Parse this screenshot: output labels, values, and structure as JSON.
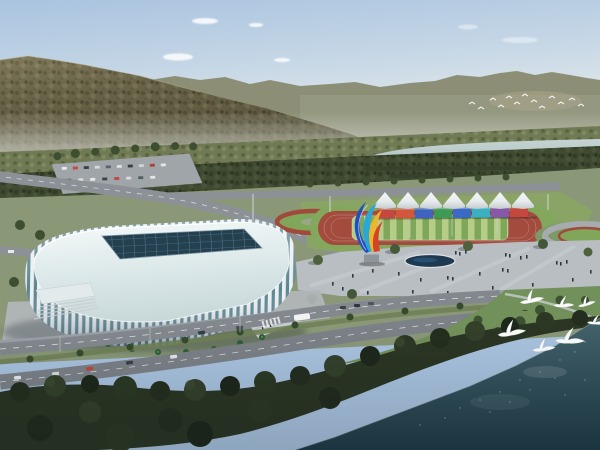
{
  "meta": {
    "domain": "natural-image",
    "title": "Aerial rendering of a riverside sports complex",
    "description": "Daytime bird's-eye architectural rendering: a white ribbed gymnasium with a dark glass skylight grid, an athletics track with rainbow-colored stands under white peaked canopies, a colorful ribbon sculpture, plazas with pedestrians, tree-lined roads with cars and a bus, forested mountains and a pale river behind, dark water in the foreground, and white egrets in flight."
  },
  "palette": {
    "sky_top": "#a9c3df",
    "sky_horizon": "#eceeec",
    "mountain_forest": "#6b6549",
    "far_ridge": "#8c8f76",
    "river": "#b3c7c9",
    "park_lawn": "#89a465",
    "track": "#a34b3c",
    "infield_light": "#b6cd87",
    "infield_dark": "#7fa75a",
    "canopy_white": "#f4f6f7",
    "plaza": "#b9bec2",
    "road": "#82888e",
    "stadium_rib": "#eaeff2",
    "stadium_glass": "#5d8590",
    "skylight": "#24404f",
    "foreground_trees": "#2b3523",
    "foreground_water": "#1f3c48",
    "egret": "#fbfdfd"
  },
  "stadium": {
    "kind": "gymnasium",
    "facade": "vertical white ribs over teal glass",
    "roof_feature": "dark rectangular skylight grid"
  },
  "park": {
    "canopy_count": 7,
    "stand_blocks": [
      "#c4483e",
      "#d0563c",
      "#3f64c0",
      "#3f9a56",
      "#3a6ac8",
      "#3ab0c0",
      "#8757a8",
      "#c4483e"
    ],
    "sculpture_colors": [
      "#2050c0",
      "#28a8d8",
      "#ecb62a",
      "#d64226"
    ]
  },
  "wildlife": {
    "egret_count": 7,
    "distant_flock_count": 13
  }
}
